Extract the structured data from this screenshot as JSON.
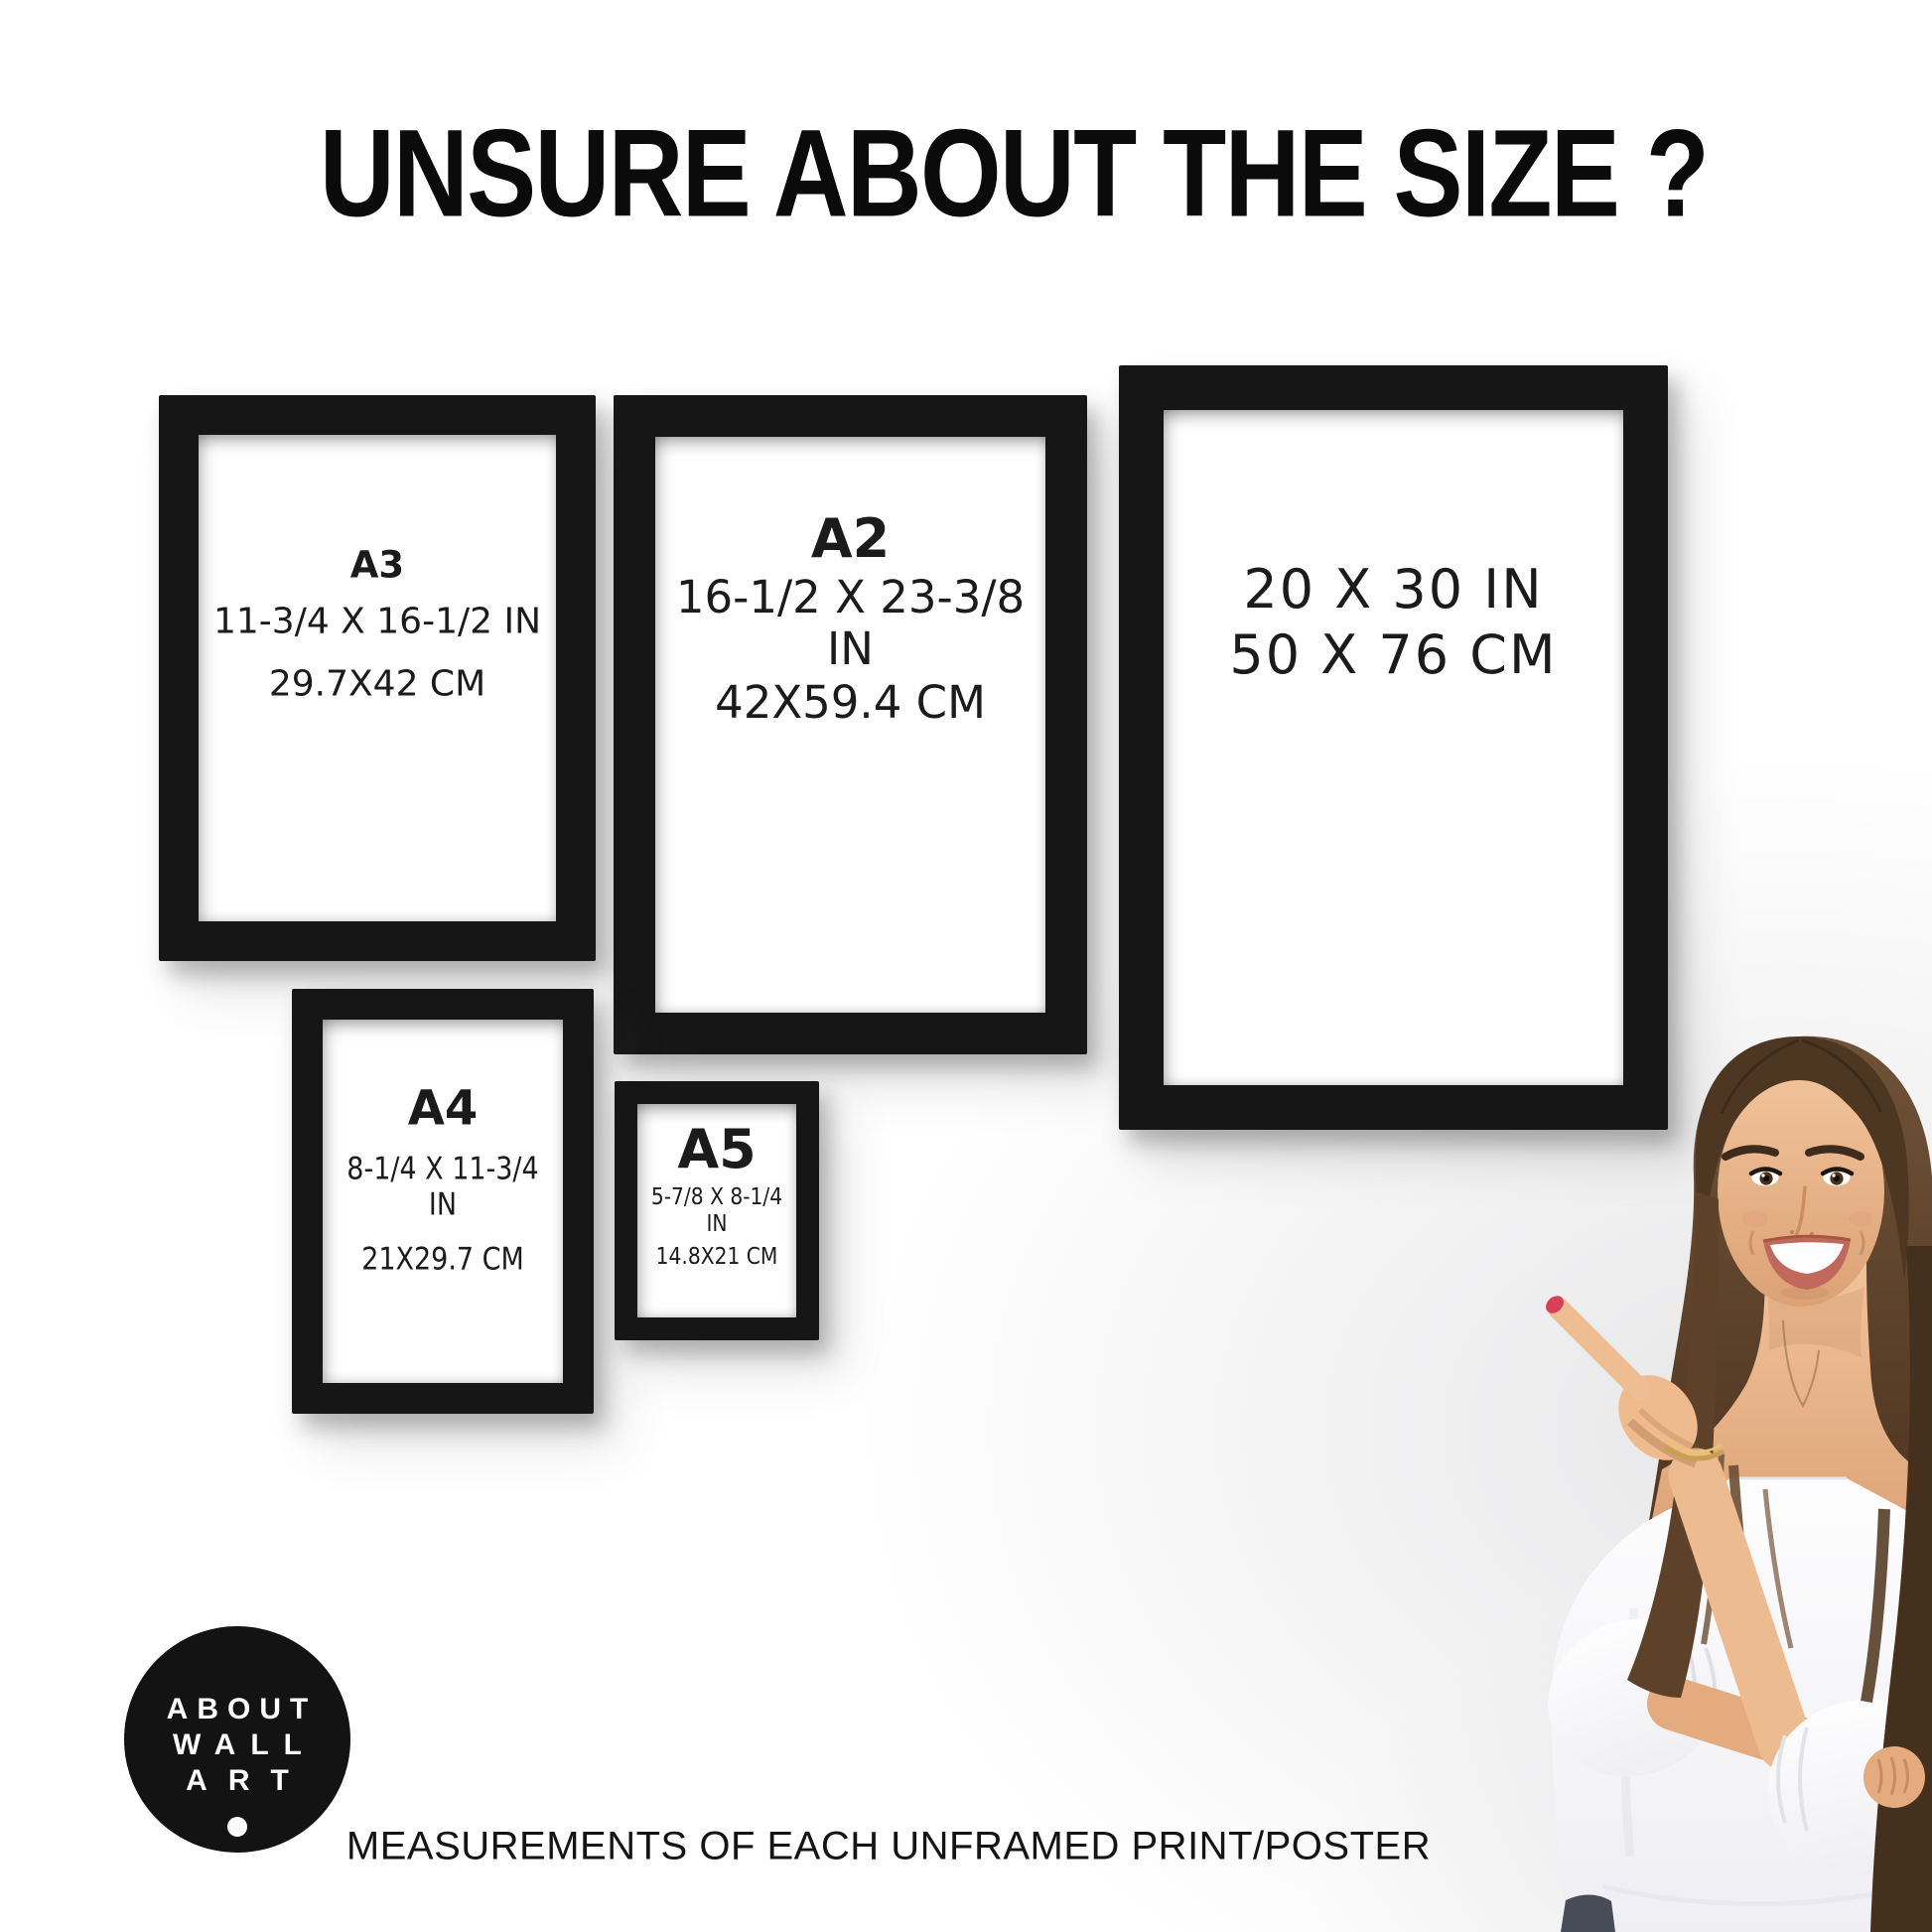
{
  "page": {
    "title": "UNSURE ABOUT THE SIZE ?",
    "footer": "MEASUREMENTS OF EACH UNFRAMED PRINT/POSTER"
  },
  "frames": [
    {
      "name": "A3",
      "label": "A3",
      "inches": "11-3/4 X 16-1/2 IN",
      "cm": "29.7X42 CM"
    },
    {
      "name": "A2",
      "label": "A2",
      "inches": "16-1/2 X 23-3/8 IN",
      "cm": "42X59.4 CM"
    },
    {
      "name": "20x30",
      "label": "",
      "inches": "20 X 30 IN",
      "cm": "50 X 76 CM"
    },
    {
      "name": "A4",
      "label": "A4",
      "inches": "8-1/4 X 11-3/4 IN",
      "cm": "21X29.7 CM"
    },
    {
      "name": "A5",
      "label": "A5",
      "inches": "5-7/8 X 8-1/4 IN",
      "cm": "14.8X21 CM"
    }
  ],
  "logo": {
    "lines": [
      "ABOUT",
      "WALL",
      "ART"
    ]
  },
  "colors": {
    "background": "#ffffff",
    "frame_black": "#161616",
    "text_black": "#1b1b1b",
    "logo_bg": "#131313",
    "logo_text": "#ffffff",
    "nail_red": "#d84057",
    "hair_brown": "#553b25",
    "skin_tone": "#eab68c",
    "blouse_white": "#fbfbfc"
  }
}
